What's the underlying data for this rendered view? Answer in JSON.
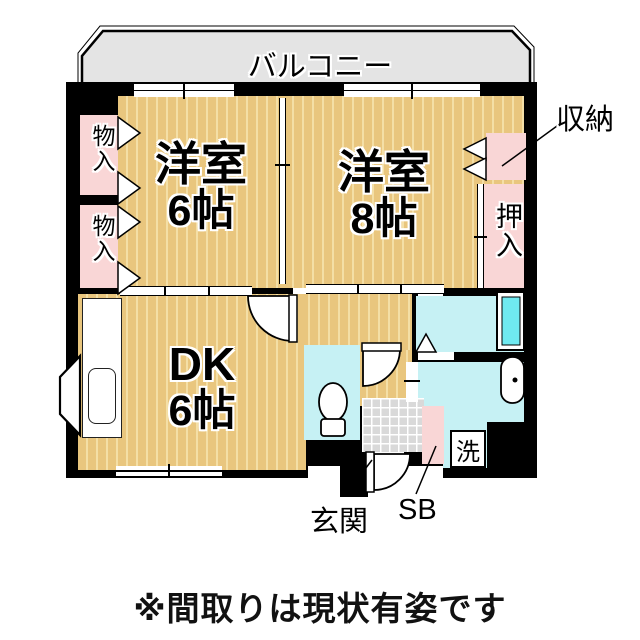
{
  "note": "※間取りは現状有姿です",
  "balcony_label": "バルコニー",
  "rooms": {
    "bedroom_west": {
      "name": "洋室",
      "size": "6帖"
    },
    "bedroom_east": {
      "name": "洋室",
      "size": "8帖"
    },
    "dining_kitchen": {
      "name": "DK",
      "size": "6帖"
    }
  },
  "storage": {
    "monoire_upper": "物入",
    "monoire_lower": "物入",
    "shunou": "収納",
    "oshiire": "押入",
    "shoe_box": "SB"
  },
  "labels": {
    "entrance": "玄関",
    "laundry": "洗"
  },
  "colors": {
    "wall": "#000000",
    "tatami_floor": "#e9c67e",
    "floor_stripe": "#f4dfa6",
    "closet_pink": "#f9d6d6",
    "wet_area_cyan": "#c6f1f4",
    "bathtub_cyan": "#6fe9f0",
    "balcony_gray": "#e4e4e4",
    "entrance_tile_gray": "#d9d9d9"
  }
}
